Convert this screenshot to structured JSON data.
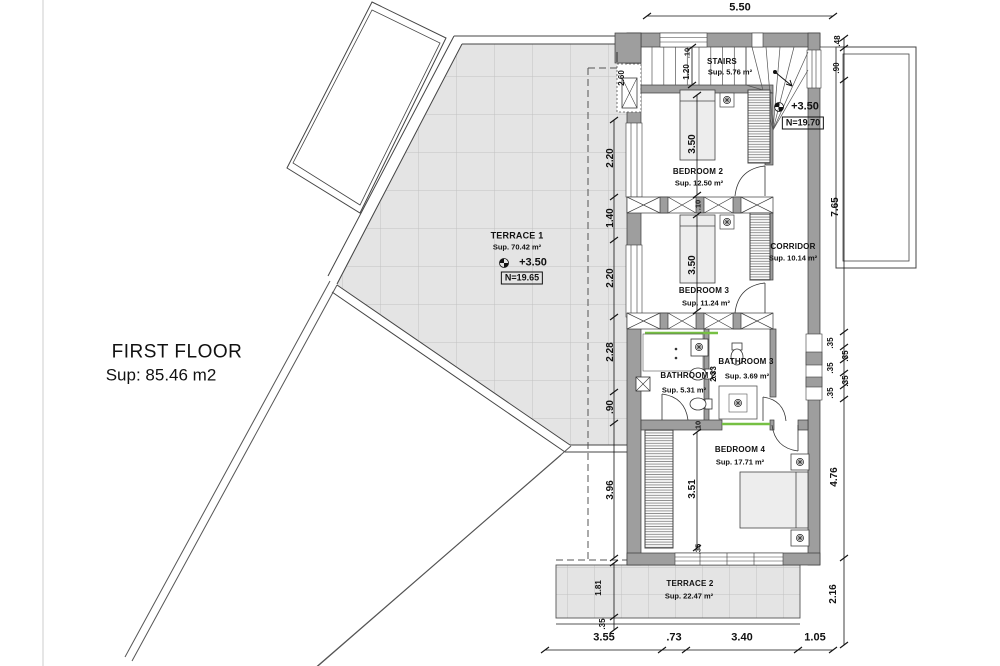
{
  "title": {
    "line1": "FIRST FLOOR",
    "line2": "Sup: 85.46 m2"
  },
  "rooms": {
    "stairs": {
      "name": "STAIRS",
      "area": "Sup. 5.76 m²"
    },
    "bedroom2": {
      "name": "BEDROOM 2",
      "area": "Sup. 12.50 m²"
    },
    "bedroom3": {
      "name": "BEDROOM 3",
      "area": "Sup. 11.24 m²"
    },
    "bedroom4": {
      "name": "BEDROOM 4",
      "area": "Sup. 17.71 m²"
    },
    "corridor": {
      "name": "CORRIDOR",
      "area": "Sup. 10.14 m²"
    },
    "bathroom2": {
      "name": "BATHROOM 2",
      "area": "Sup. 5.31 m²"
    },
    "bathroom3": {
      "name": "BATHROOM 3",
      "area": "Sup. 3.69 m²"
    },
    "terrace1": {
      "name": "TERRACE 1",
      "area": "Sup. 70.42 m²",
      "level": "+3.50",
      "datum": "N=19.65"
    },
    "terrace2": {
      "name": "TERRACE 2",
      "area": "Sup. 22.47 m²"
    }
  },
  "levels": {
    "stairs_level": "+3.50",
    "stairs_datum": "N=19.70"
  },
  "dimensions": {
    "top": [
      "5.50"
    ],
    "bottom": [
      "3.55",
      ".73",
      "3.40",
      "1.05"
    ],
    "left": [
      "2.60",
      "2.20",
      "1.40",
      "2.20",
      "2.28",
      ".90",
      "3.96",
      "1.81",
      ".35"
    ],
    "right": [
      ".48",
      ".90",
      "7.65",
      ".35",
      ".35",
      ".35",
      ".35",
      ".35",
      "4.76",
      "2.16"
    ],
    "interior": [
      ".10",
      "1.20",
      "3.50",
      ".10",
      "3.50",
      "2.33",
      ".10",
      "3.51",
      ".35"
    ]
  },
  "colors": {
    "wall_gray": "#9e9e9e",
    "tile_gray": "#e4e4e4",
    "accent_green": "#76c043",
    "line": "#333333"
  }
}
